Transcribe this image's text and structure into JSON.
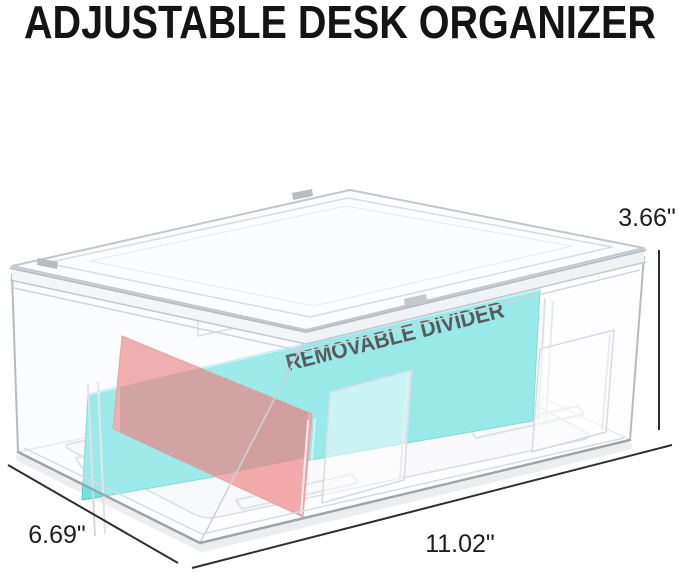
{
  "title": "ADJUSTABLE DESK ORGANIZER",
  "figure": {
    "divider_label": "REMOVABLE DIVIDER",
    "dimensions": {
      "height": "3.66\"",
      "depth": "6.69\"",
      "width": "11.02\""
    }
  },
  "colors": {
    "divider_cyan": "#6FE4E1",
    "divider_red": "#EF8888",
    "divider_overlap": "#C17876",
    "dimension_line": "#2E2E2E",
    "title_text": "#141414",
    "label_text": "#161616"
  }
}
